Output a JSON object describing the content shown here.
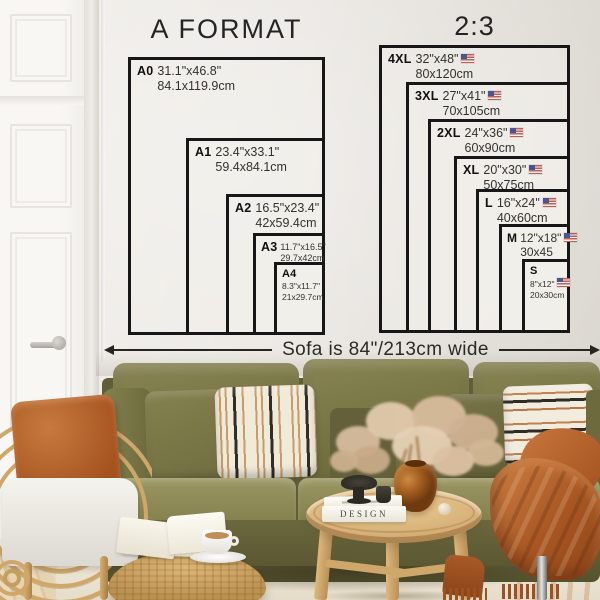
{
  "poster_guide": {
    "a_format": {
      "title": "A FORMAT",
      "sizes": [
        {
          "label": "A0",
          "inches": "31.1\"x46.8\"",
          "cm": "84.1x119.9cm"
        },
        {
          "label": "A1",
          "inches": "23.4\"x33.1\"",
          "cm": "59.4x84.1cm"
        },
        {
          "label": "A2",
          "inches": "16.5\"x23.4\"",
          "cm": "42x59.4cm"
        },
        {
          "label": "A3",
          "inches": "11.7\"x16.5\"",
          "cm": "29.7x42cm"
        },
        {
          "label": "A4",
          "inches": "8.3\"x11.7\"",
          "cm": "21x29.7cm"
        }
      ]
    },
    "ratio_2_3": {
      "title": "2:3",
      "flag_icon": "us-flag",
      "sizes": [
        {
          "label": "4XL",
          "inches": "32\"x48\"",
          "cm": "80x120cm"
        },
        {
          "label": "3XL",
          "inches": "27\"x41\"",
          "cm": "70x105cm"
        },
        {
          "label": "2XL",
          "inches": "24\"x36\"",
          "cm": "60x90cm"
        },
        {
          "label": "XL",
          "inches": "20\"x30\"",
          "cm": "50x75cm"
        },
        {
          "label": "L",
          "inches": "16\"x24\"",
          "cm": "40x60cm"
        },
        {
          "label": "M",
          "inches": "12\"x18\"",
          "cm": "30x45"
        },
        {
          "label": "S",
          "inches": "8\"x12\"",
          "cm": "20x30cm"
        }
      ]
    },
    "sofa_note": "Sofa is 84\"/213cm wide"
  },
  "scene": {
    "book_spine_title": "DESIGN"
  },
  "colors": {
    "line_black": "#171717",
    "wall": "#e9e6e1",
    "sofa_olive": "#75723f",
    "pillow_rust": "#b2592a",
    "throw_rust": "#a85723",
    "rattan": "#cfa769",
    "table_wood": "#d5ae74",
    "flag_red": "#c0605a",
    "flag_blue": "#4a5490"
  }
}
